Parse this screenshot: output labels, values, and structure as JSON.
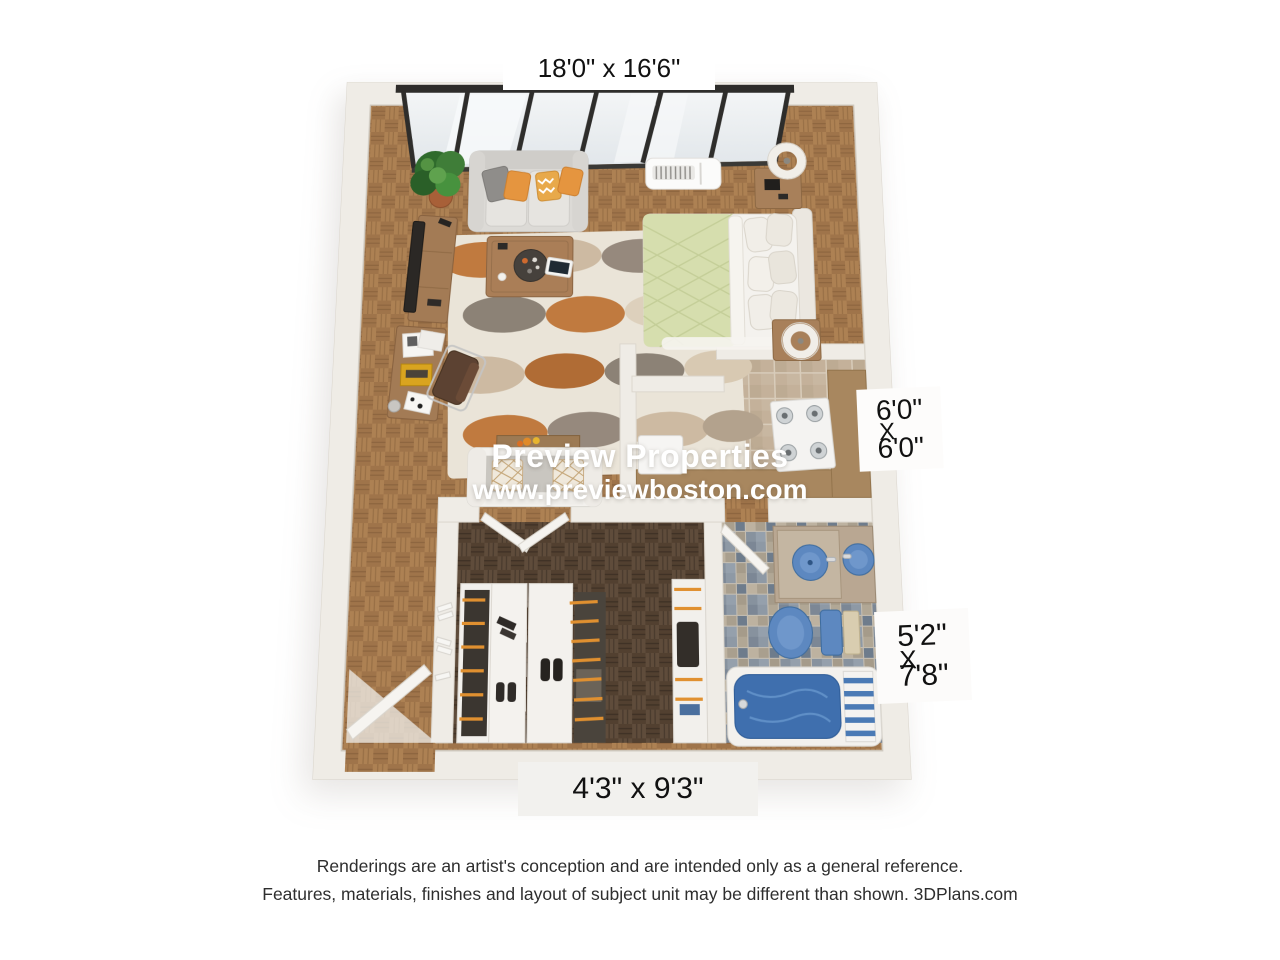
{
  "canvas": {
    "width": 1280,
    "height": 960,
    "background": "#ffffff"
  },
  "watermark": {
    "line1": "Preview Properties",
    "line2": "www.previewboston.com"
  },
  "dimension_labels": {
    "main_room": {
      "text": "18'0\" x 16'6\""
    },
    "kitchen": {
      "width": "6'0\"",
      "separator": "X",
      "depth": "6'0\""
    },
    "bathroom": {
      "width": "5'2\"",
      "separator": "X",
      "depth": "7'8\""
    },
    "closet": {
      "text": "4'3\" x 9'3\""
    }
  },
  "disclaimer": {
    "line1": "Renderings are an artist's conception and are intended only as a general reference.",
    "line2": "Features, materials, finishes and layout of subject unit may be different than shown. 3DPlans.com"
  },
  "colors": {
    "wall": "#efece6",
    "wall_edge": "#d9d4cb",
    "floor_living": "#ad8153",
    "floor_living_alt": "#9f744a",
    "floor_closet": "#5f4c3b",
    "floor_closet_alt": "#524030",
    "kitchen_tile": "#c4b19a",
    "kitchen_tile_grout": "#d8ccba",
    "counter_wood": "#a8875f",
    "bath_mosaic": "#a09889",
    "fixture_blue": "#5d88c0",
    "tub_blue": "#3f6fae",
    "sofa_gray": "#dcdad6",
    "pillow_orange": "#e5953f",
    "bed_green": "#d6deae",
    "rug_orange": "#c07a3f",
    "rug_gray": "#96897d",
    "window_frame": "#2e2d2b",
    "watermark_text": "#ffffff",
    "label_text": "#111111",
    "disclaimer_text": "#2e2e2e"
  }
}
